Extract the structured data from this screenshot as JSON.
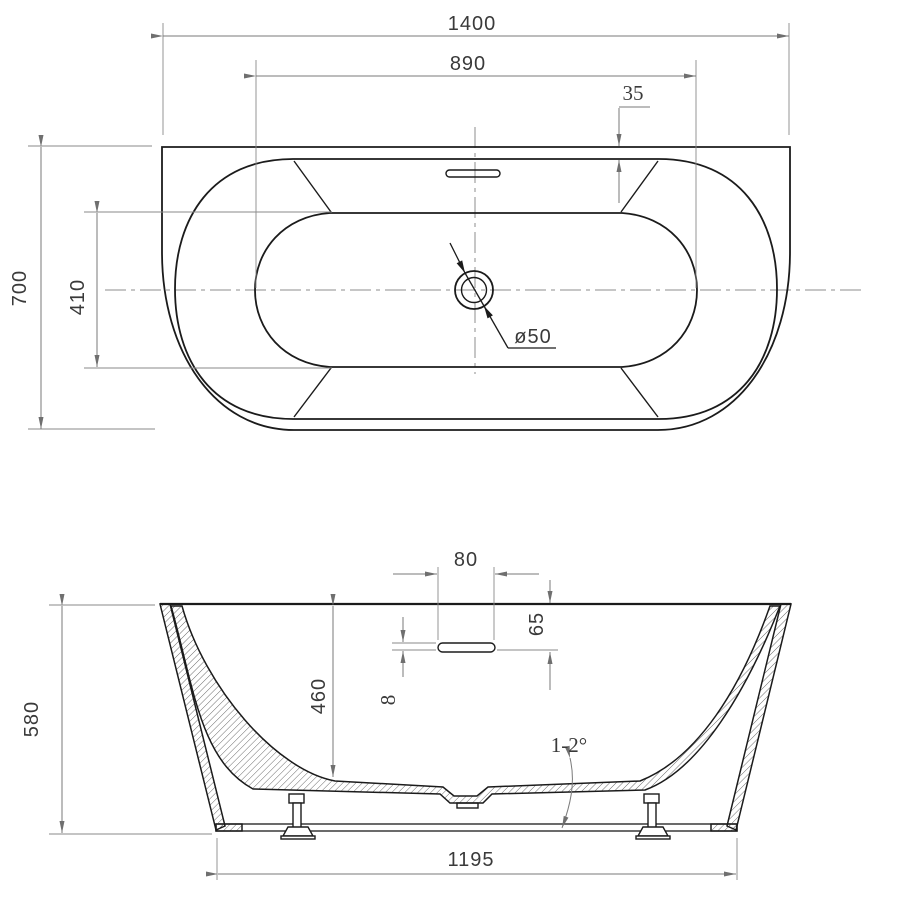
{
  "colors": {
    "object_line": "#1b1b1b",
    "dimension_line": "#7a7a7a",
    "text": "#3a3a3a",
    "background": "#ffffff"
  },
  "top_view": {
    "overall_width": "1400",
    "basin_max_width": "890",
    "back_rim_width": "35",
    "overall_depth": "700",
    "basin_depth": "410",
    "drain_diameter_label": "ø50"
  },
  "side_view": {
    "overflow_slot_width": "80",
    "overflow_top_offset": "65",
    "overflow_slot_height": "8",
    "basin_inner_depth": "460",
    "overall_height": "580",
    "floor_slope": "1-2°",
    "base_length": "1195"
  }
}
